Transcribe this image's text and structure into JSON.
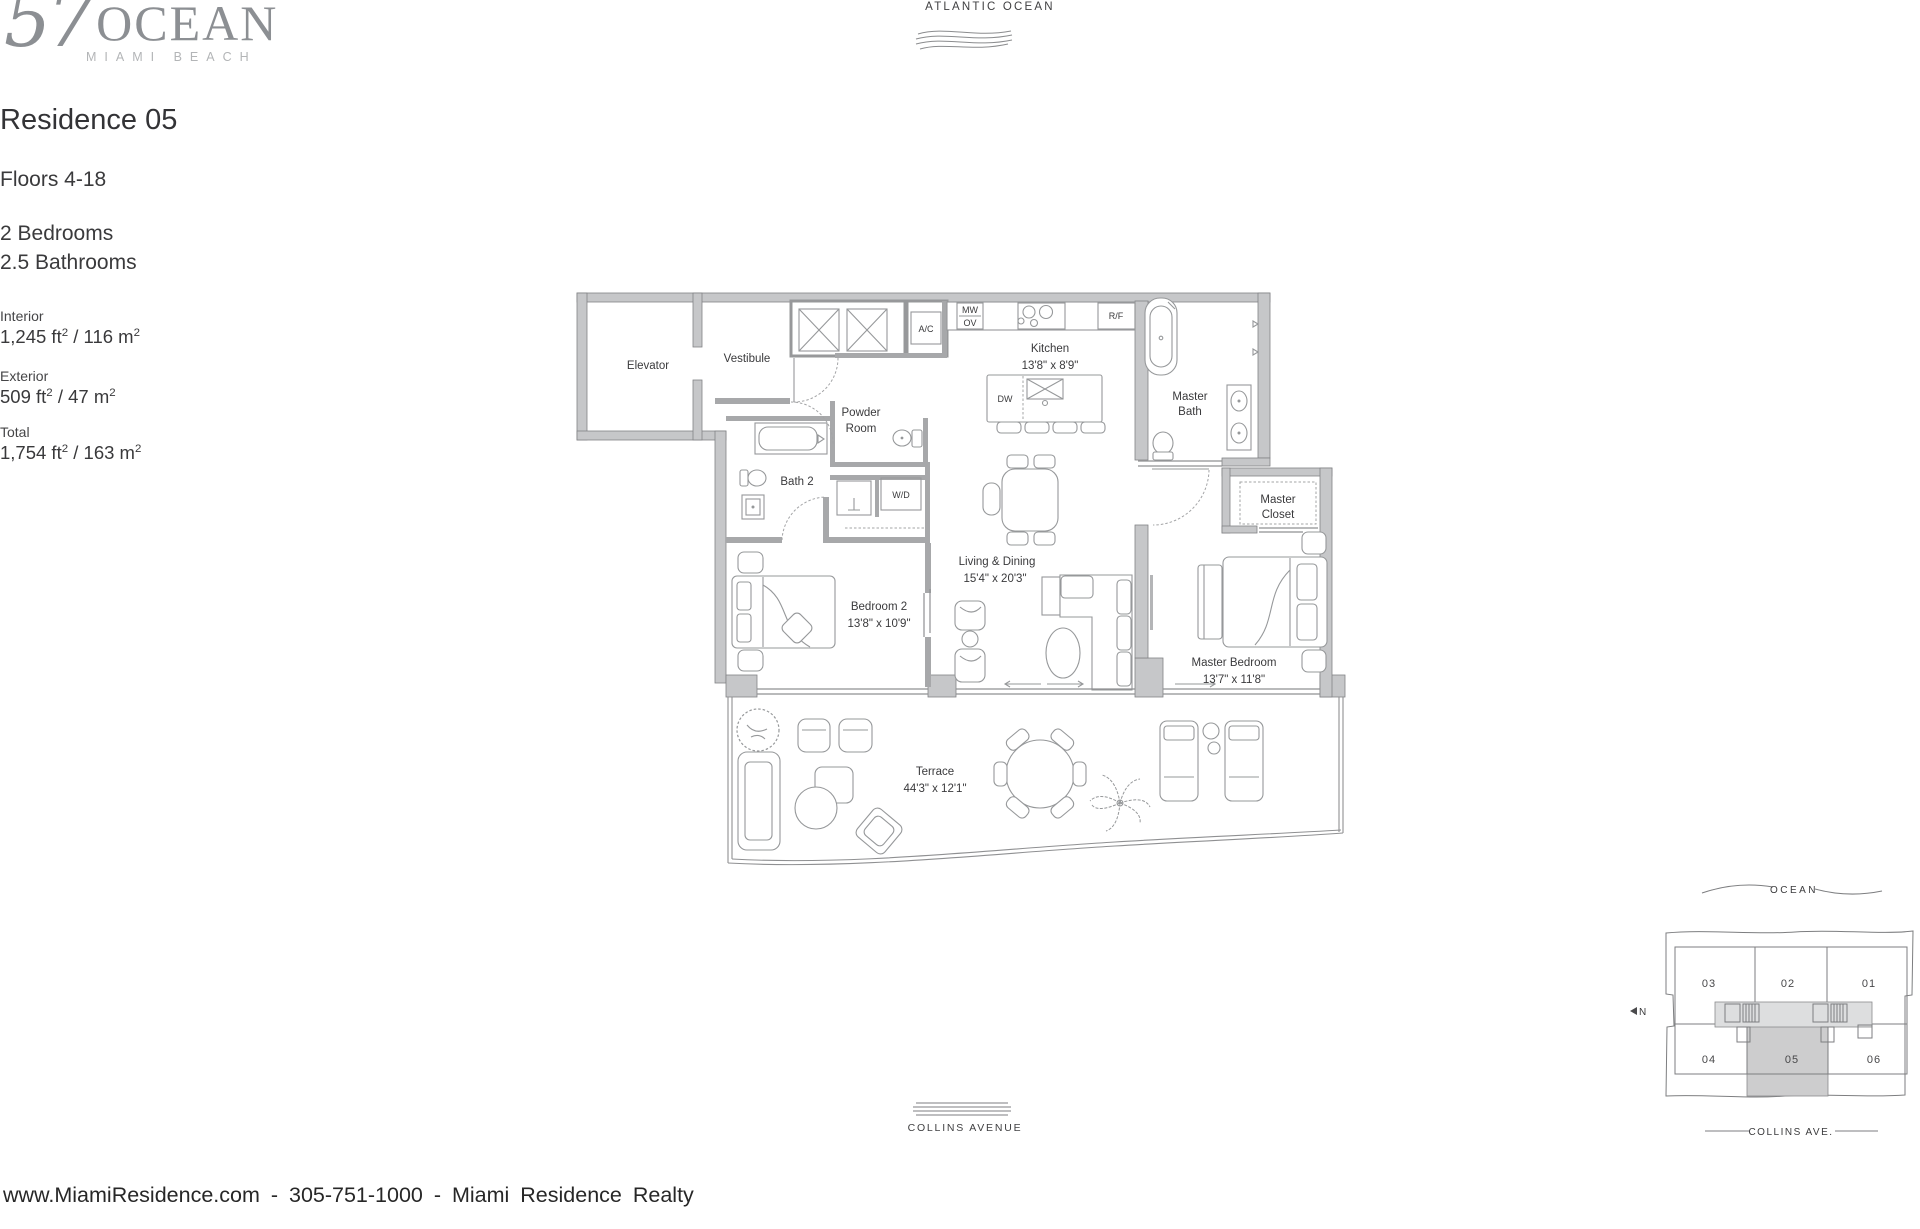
{
  "logo": {
    "number": "57",
    "name": "OCEAN",
    "subtitle": "MIAMI BEACH"
  },
  "top_label": {
    "ocean": "ATLANTIC OCEAN"
  },
  "residence": {
    "title": "Residence 05",
    "floors": "Floors 4-18",
    "bedrooms": "2 Bedrooms",
    "bathrooms": "2.5 Bathrooms",
    "areas": {
      "interior": {
        "label": "Interior",
        "ft": "1,245 ft",
        "ft_sup": "2",
        "m": " / 116 m",
        "m_sup": "2"
      },
      "exterior": {
        "label": "Exterior",
        "ft": "509 ft",
        "ft_sup": "2",
        "m": " / 47 m",
        "m_sup": "2"
      },
      "total": {
        "label": "Total",
        "ft": "1,754 ft",
        "ft_sup": "2",
        "m": " / 163 m",
        "m_sup": "2"
      }
    }
  },
  "floorplan": {
    "rooms": {
      "elevator": {
        "name": "Elevator"
      },
      "vestibule": {
        "name": "Vestibule"
      },
      "ac": {
        "name": "A/C"
      },
      "mwov": {
        "line1": "MW",
        "line2": "OV"
      },
      "rf": {
        "name": "R/F"
      },
      "dw": {
        "name": "DW"
      },
      "kitchen": {
        "name": "Kitchen",
        "dims": "13'8\" x 8'9\""
      },
      "powder": {
        "line1": "Powder",
        "line2": "Room"
      },
      "master_bath": {
        "line1": "Master",
        "line2": "Bath"
      },
      "bath2": {
        "name": "Bath 2"
      },
      "wd": {
        "name": "W/D"
      },
      "master_closet": {
        "line1": "Master",
        "line2": "Closet"
      },
      "living": {
        "name": "Living & Dining",
        "dims": "15'4\" x 20'3\""
      },
      "bedroom2": {
        "name": "Bedroom 2",
        "dims": "13'8\" x 10'9\""
      },
      "master_bedroom": {
        "name": "Master Bedroom",
        "dims": "13'7\" x 11'8\""
      },
      "terrace": {
        "name": "Terrace",
        "dims": "44'3\" x 12'1\""
      }
    }
  },
  "keyplan": {
    "ocean_label": "OCEAN",
    "street_label": "COLLINS AVE.",
    "north_label": "N",
    "units": {
      "u01": "01",
      "u02": "02",
      "u03": "03",
      "u04": "04",
      "u05": "05",
      "u06": "06"
    },
    "highlighted_unit": "05"
  },
  "street": {
    "label": "COLLINS AVENUE"
  },
  "footer": {
    "text": "www.MiamiResidence.com - 305-751-1000 - Miami Residence Realty"
  },
  "colors": {
    "wall_fill": "#c6c7c9",
    "line": "#8f9092",
    "text": "#3a3a3c",
    "logo": "#8c8f93",
    "highlight": "#cdcdce"
  }
}
